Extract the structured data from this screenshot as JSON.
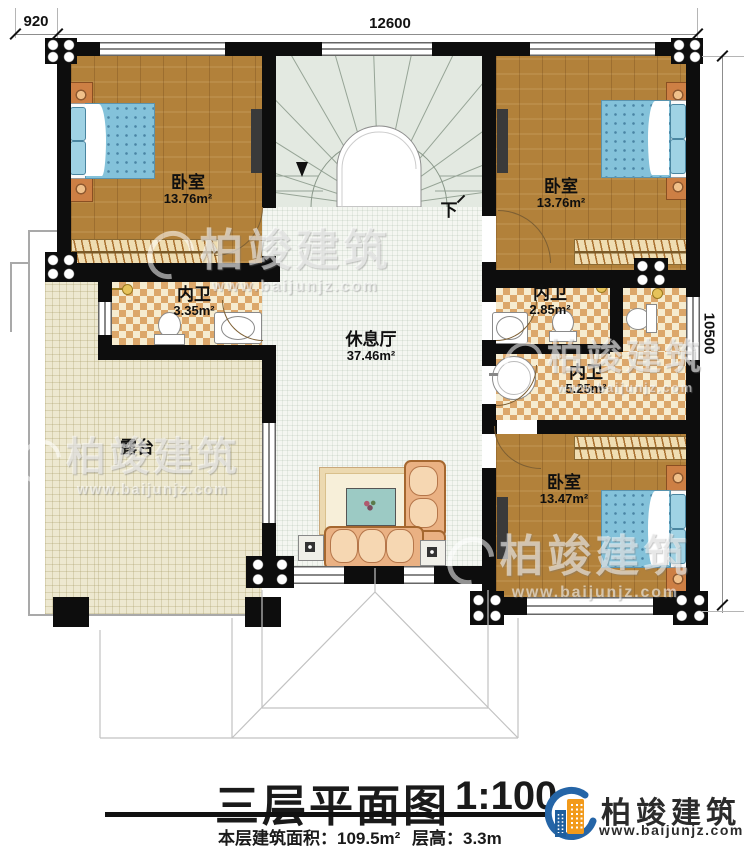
{
  "dimensions": {
    "left": "920",
    "top": "12600",
    "right": "10500"
  },
  "rooms": {
    "bedroom_tl": {
      "name": "卧室",
      "area": "13.76m²"
    },
    "bedroom_tr": {
      "name": "卧室",
      "area": "13.76m²"
    },
    "bedroom_br": {
      "name": "卧室",
      "area": "13.47m²"
    },
    "bath_left": {
      "name": "内卫",
      "area": "3.35m²"
    },
    "bath_right_small": {
      "name": "内卫",
      "area": "2.85m²"
    },
    "bath_right_large": {
      "name": "内卫",
      "area": "5.25m²"
    },
    "hall": {
      "name": "休息厅",
      "area": "37.46m²"
    },
    "terrace": {
      "name": "露台"
    }
  },
  "stairs": {
    "down_label": "下"
  },
  "title": {
    "main": "三层平面图",
    "scale": "1:100",
    "area_label": "本层建筑面积：",
    "area_value": "109.5m²",
    "height_label": "层高：",
    "height_value": "3.3m"
  },
  "brand": {
    "name": "柏竣建筑",
    "website": "www.baijunjz.com"
  },
  "watermark": {
    "name": "柏竣建筑",
    "website": "www.baijunjz.com"
  },
  "colors": {
    "wall": "#0d0d0d",
    "wood": "#b2813a",
    "tile_light": "#f6ecd0",
    "tile_dark": "#dca76a",
    "stairs": "#e3e9e1",
    "hall_floor": "#f4f6f1",
    "terrace": "#ede8d0",
    "bed": "#84c2da",
    "logo_blue": "#2565a7",
    "logo_orange": "#f29a1b"
  }
}
